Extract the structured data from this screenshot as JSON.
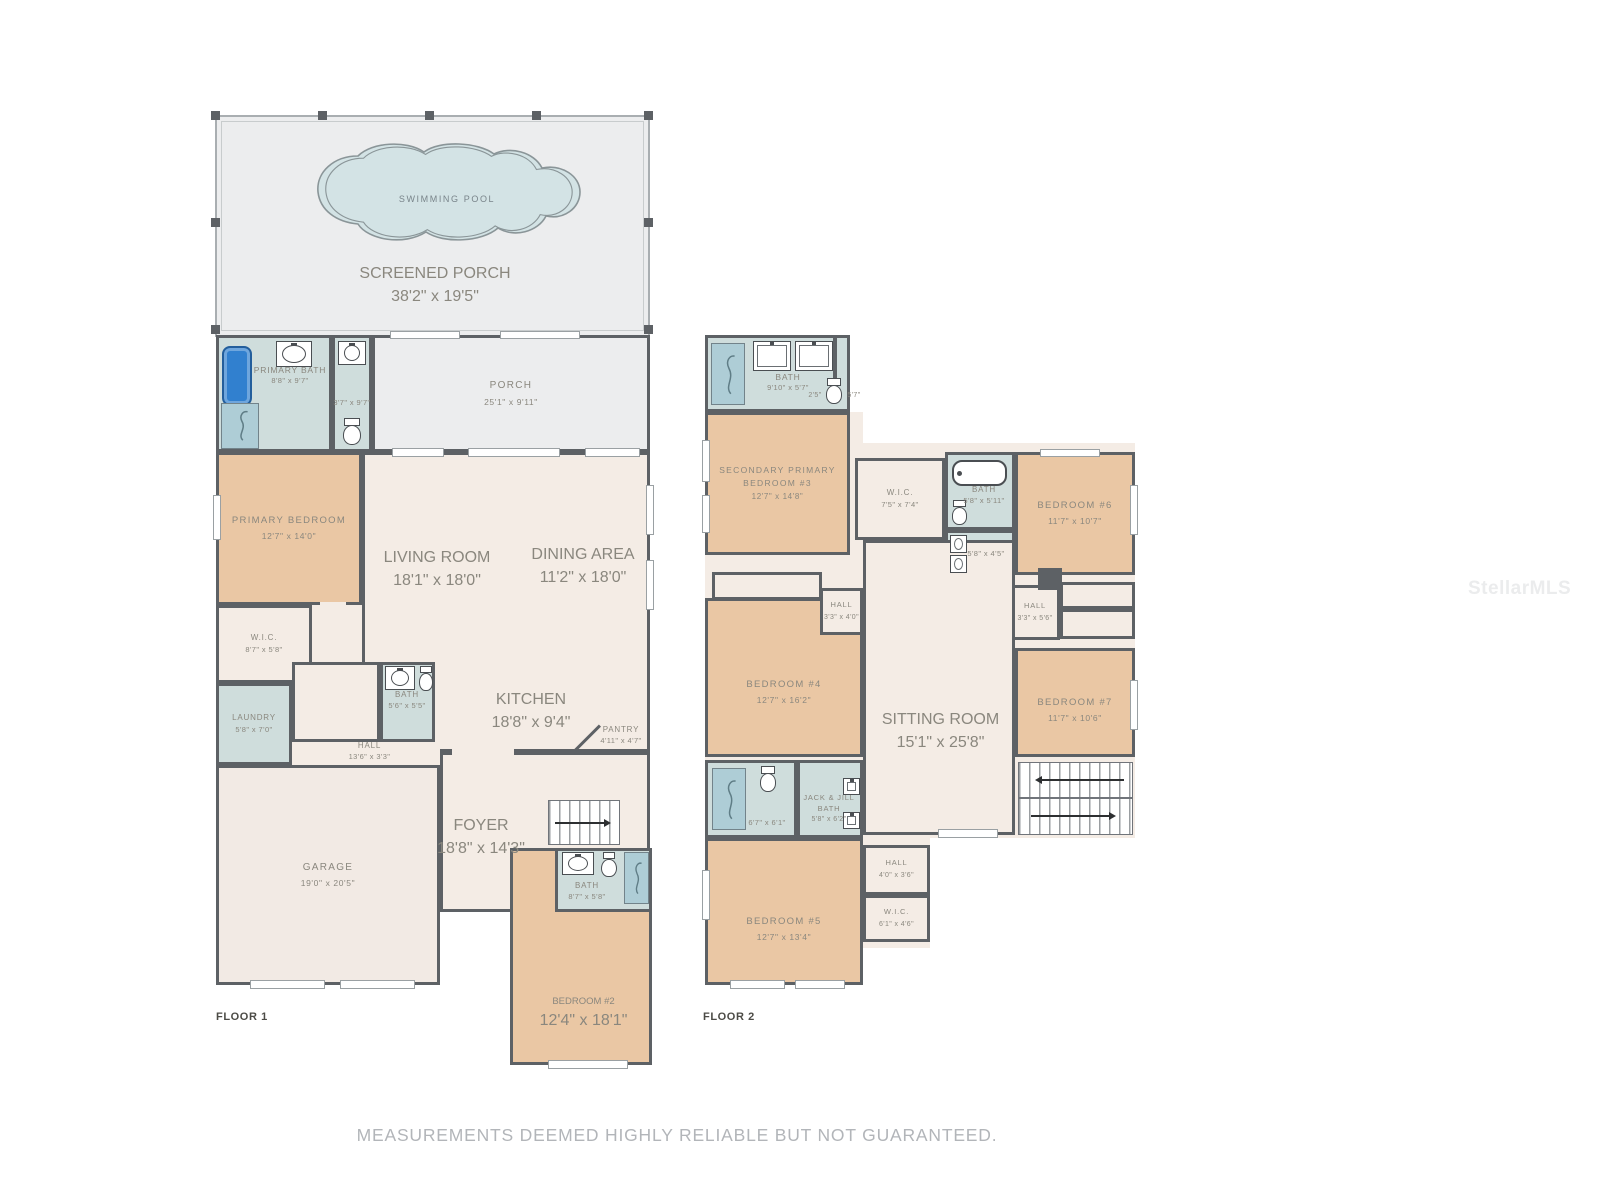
{
  "colors": {
    "wall": "#5d6165",
    "floor_fill": "#f4ece5",
    "bedroom_fill": "#eac7a4",
    "wet_room_fill": "#cfdddc",
    "porch_fill": "#ecedee",
    "pool_fill": "#d3e3e5",
    "fixture_blue": "#3180cf",
    "label_text": "#8a877e"
  },
  "floor1": {
    "label": "FLOOR 1",
    "screened_porch": {
      "name": "SCREENED PORCH",
      "dims": "38'2\" x 19'5\""
    },
    "swimming_pool": {
      "name": "SWIMMING POOL"
    },
    "primary_bath": {
      "name": "PRIMARY BATH",
      "dims": "8'8\" x 9'7\""
    },
    "water_closet": {
      "dims": "3'7\" x 9'7\""
    },
    "porch": {
      "name": "PORCH",
      "dims": "25'1\" x 9'11\""
    },
    "primary_bedroom": {
      "name": "PRIMARY BEDROOM",
      "dims": "12'7\" x 14'0\""
    },
    "living_room": {
      "name": "LIVING ROOM",
      "dims": "18'1\" x 18'0\""
    },
    "dining_area": {
      "name": "DINING AREA",
      "dims": "11'2\" x 18'0\""
    },
    "wic": {
      "name": "W.I.C.",
      "dims": "8'7\" x 5'8\""
    },
    "bath": {
      "name": "BATH",
      "dims": "5'6\" x 5'5\""
    },
    "laundry": {
      "name": "LAUNDRY",
      "dims": "5'8\" x 7'0\""
    },
    "hall": {
      "name": "HALL",
      "dims": "13'6\" x 3'3\""
    },
    "kitchen": {
      "name": "KITCHEN",
      "dims": "18'8\" x 9'4\""
    },
    "pantry": {
      "name": "PANTRY",
      "dims": "4'11\" x 4'7\""
    },
    "garage": {
      "name": "GARAGE",
      "dims": "19'0\" x 20'5\""
    },
    "foyer": {
      "name": "FOYER",
      "dims": "18'8\" x 14'3\""
    },
    "bath2": {
      "name": "BATH",
      "dims": "8'7\" x 5'8\""
    },
    "bedroom2": {
      "name": "BEDROOM #2",
      "dims": "12'4\" x 18'1\""
    }
  },
  "floor2": {
    "label": "FLOOR 2",
    "bath_top": {
      "name": "BATH",
      "dims": "9'10\" x 5'7\""
    },
    "water_closet": {
      "dim_a": "2'5\"",
      "dim_b": "5'7\""
    },
    "bedroom3": {
      "name_line1": "SECONDARY PRIMARY",
      "name_line2": "BEDROOM #3",
      "dims": "12'7\" x 14'8\""
    },
    "wic_a": {
      "name": "W.I.C.",
      "dims": "7'5\" x 7'4\""
    },
    "bath_mid": {
      "name": "BATH",
      "dims": "5'8\" x 5'11\""
    },
    "closet": {
      "dims": "5'8\" x 4'5\""
    },
    "bedroom6": {
      "name": "BEDROOM #6",
      "dims": "11'7\" x 10'7\""
    },
    "hall_a": {
      "name": "HALL",
      "dims": "3'3\" x 4'0\""
    },
    "hall_b": {
      "name": "HALL",
      "dims": "3'3\" x 5'6\""
    },
    "bedroom4": {
      "name": "BEDROOM #4",
      "dims": "12'7\" x 16'2\""
    },
    "sitting_room": {
      "name": "SITTING ROOM",
      "dims": "15'1\" x 25'8\""
    },
    "bedroom7": {
      "name": "BEDROOM #7",
      "dims": "11'7\" x 10'6\""
    },
    "bath_c": {
      "dims": "6'7\" x 6'1\""
    },
    "jack_jill_bath": {
      "name_line1": "JACK & JILL",
      "name_line2": "BATH",
      "dims": "5'8\" x 6'2\""
    },
    "hall_c": {
      "name": "HALL",
      "dims": "4'0\" x 3'6\""
    },
    "bedroom5": {
      "name": "BEDROOM #5",
      "dims": "12'7\" x 13'4\""
    },
    "wic_b": {
      "name": "W.I.C.",
      "dims": "6'1\" x 4'6\""
    }
  },
  "footer": {
    "disclaimer": "MEASUREMENTS DEEMED HIGHLY RELIABLE BUT NOT GUARANTEED."
  },
  "watermark": "StellarMLS"
}
